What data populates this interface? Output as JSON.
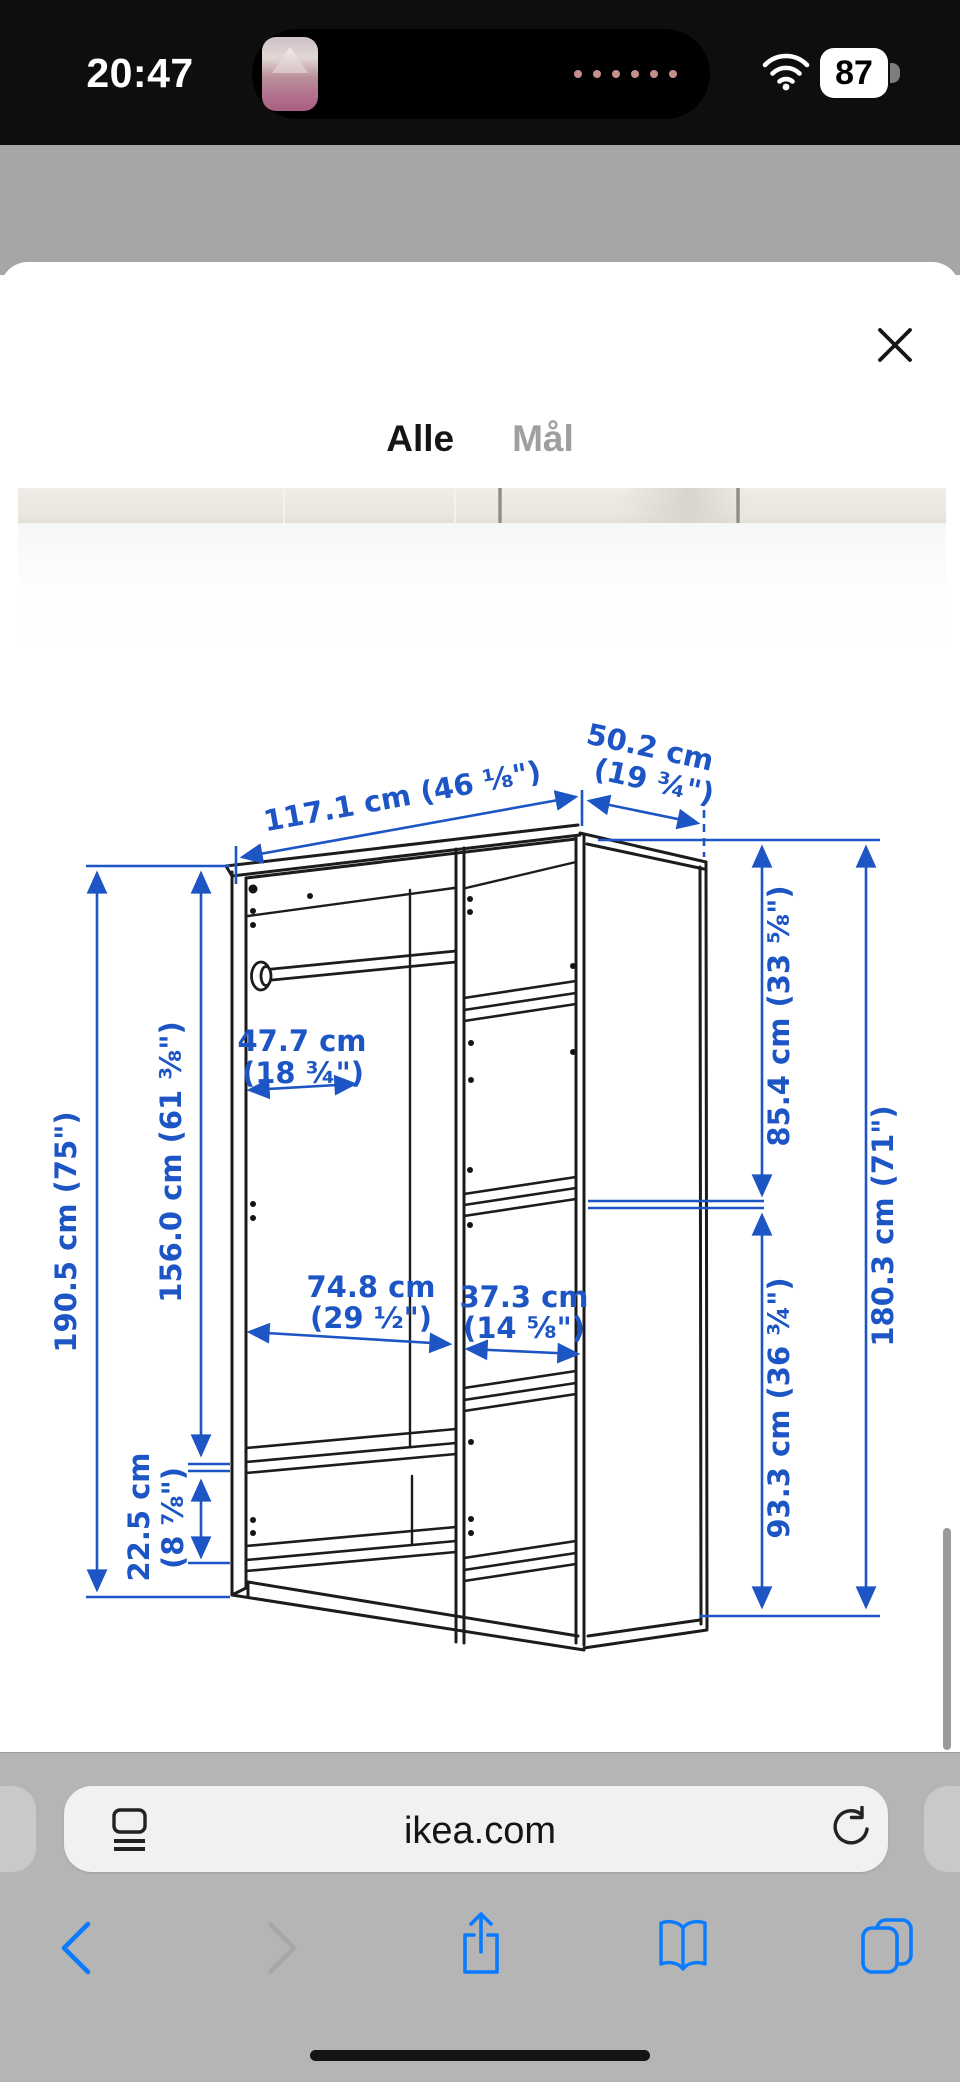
{
  "status_bar": {
    "time": "20:47",
    "battery": "87"
  },
  "page_banner": {
    "text": "Skal vi hjælpe med at tegne din nye"
  },
  "modal": {
    "tabs": [
      {
        "label": "Alle"
      },
      {
        "label": "Mål"
      }
    ]
  },
  "diagram": {
    "labels": {
      "w_front": "117.1 cm (46 ⅛\")",
      "d_top1": "50.2 cm",
      "d_top2": "(19 ¾\")",
      "h_total": "190.5 cm (75\")",
      "h_inner": "156.0 cm (61 ⅜\")",
      "plinth1": "22.5 cm",
      "plinth2": "(8 ⅞\")",
      "rail1": "47.7 cm",
      "rail2": "(18 ¾\")",
      "left_w1": "74.8 cm",
      "left_w2": "(29 ½\")",
      "mid_w1": "37.3 cm",
      "mid_w2": "(14 ⅝\")",
      "right_top": "85.4 cm (33 ⅝\")",
      "right_bottom": "93.3 cm (36 ¾\")",
      "right_total": "180.3 cm (71\")"
    }
  },
  "browser": {
    "url": "ikea.com"
  },
  "colors": {
    "dimension_blue": "#1d55c4",
    "ios_blue": "#0a7aff",
    "ikea_blue_dimmed": "#1f4e79",
    "status_bar_bg": "#0e0e0f",
    "chrome_gray": "#b5b5b5"
  }
}
